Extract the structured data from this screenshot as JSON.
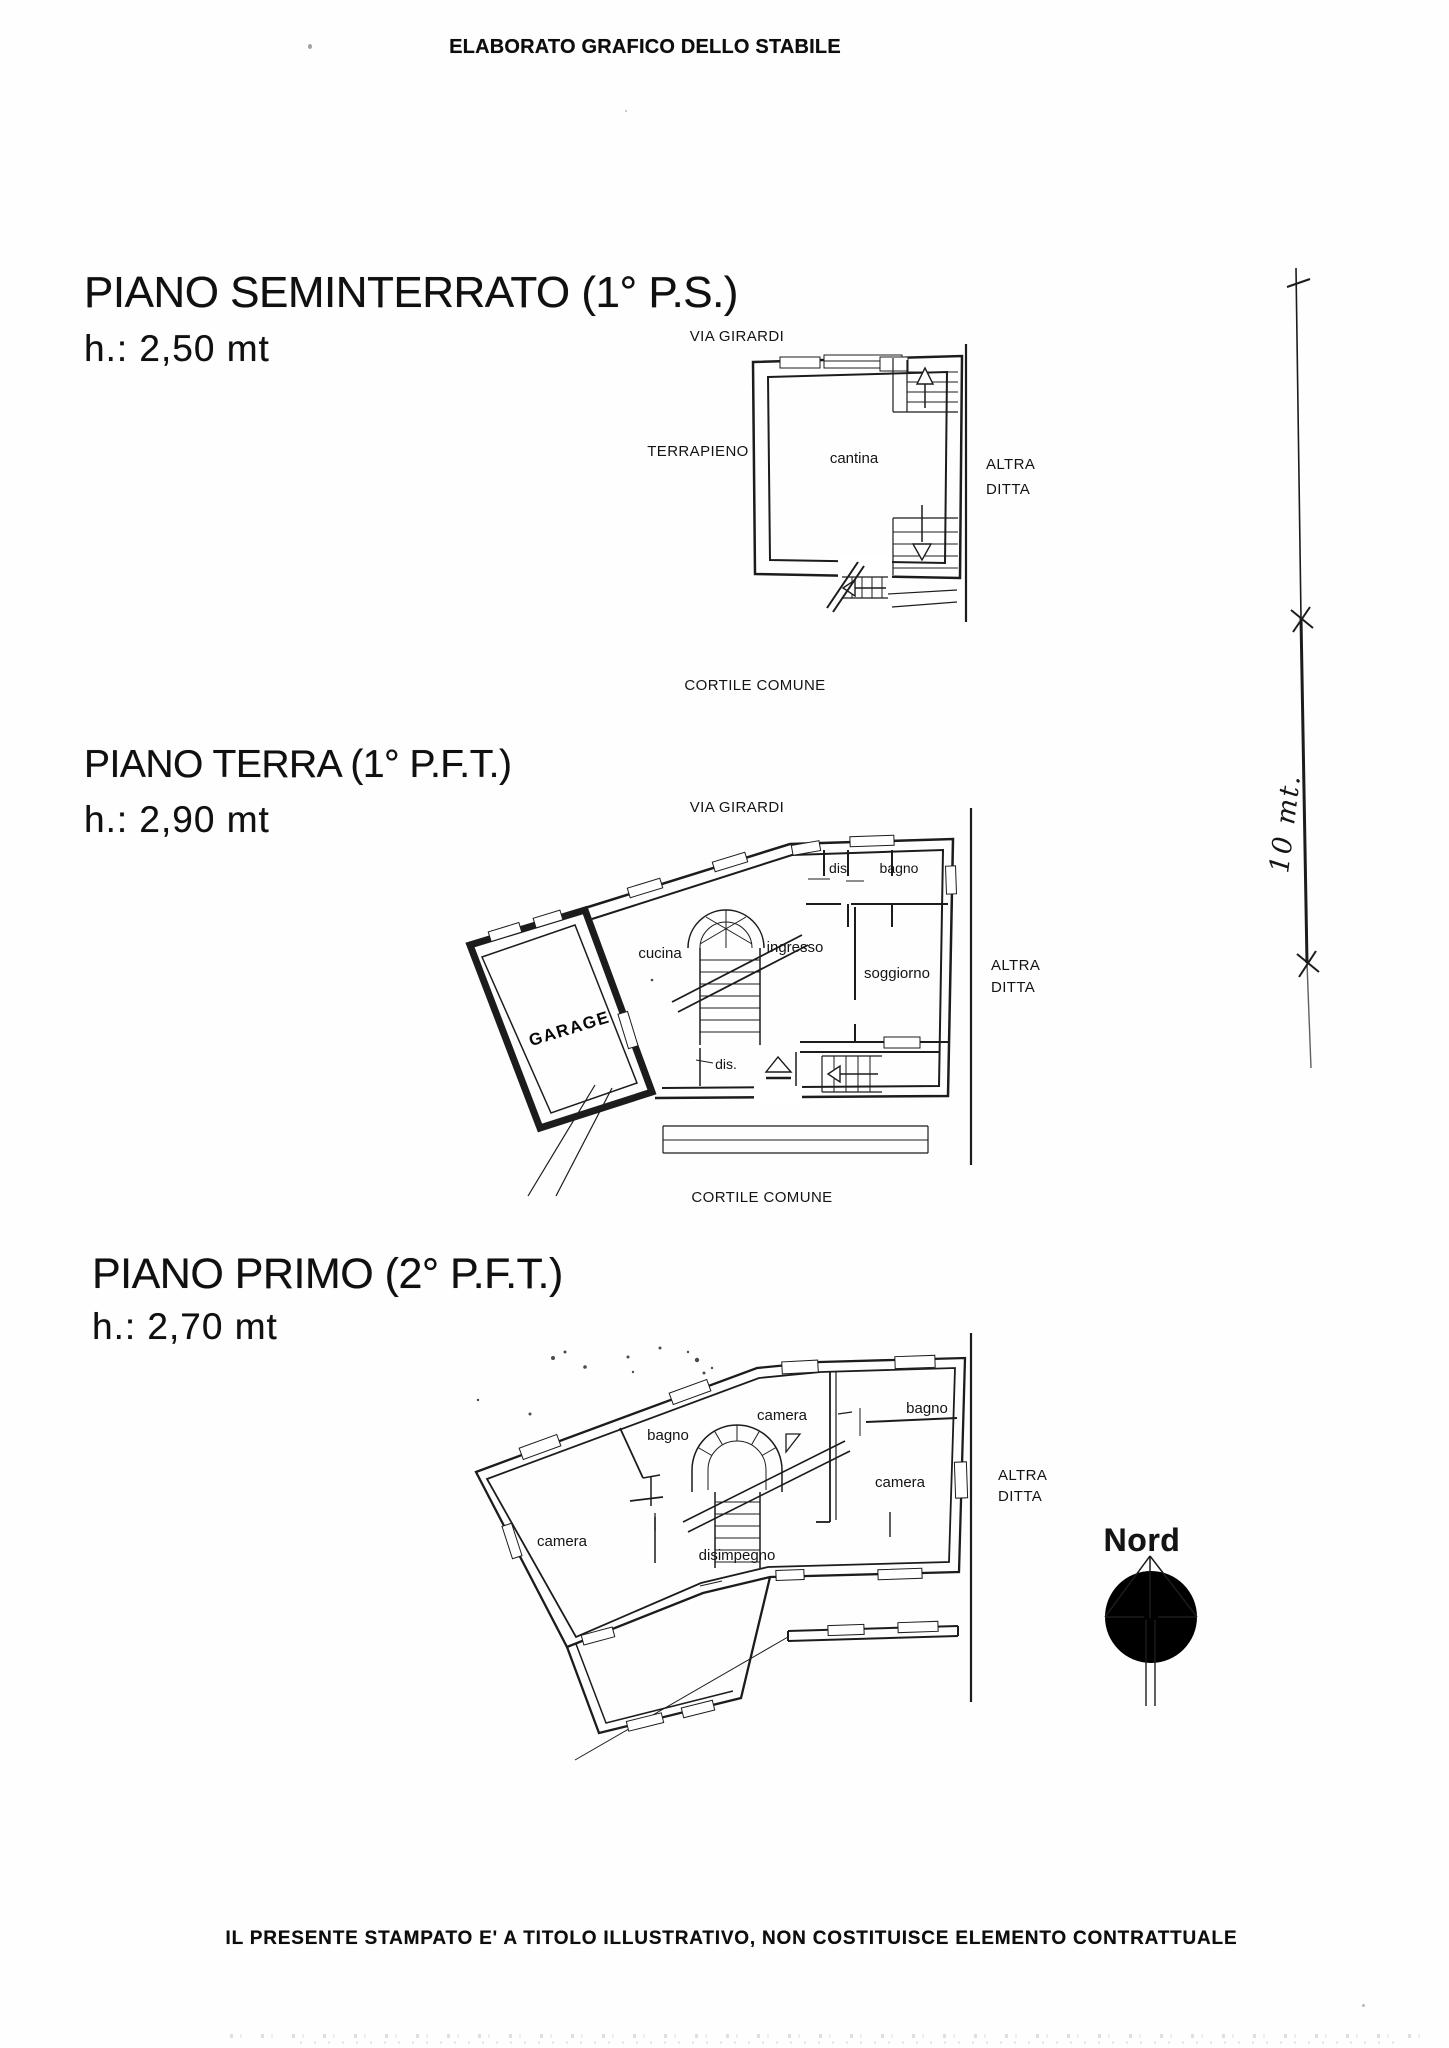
{
  "document": {
    "title": "ELABORATO GRAFICO DELLO STABILE",
    "disclaimer": "IL PRESENTE STAMPATO E' A TITOLO ILLUSTRATIVO, NON COSTITUISCE ELEMENTO CONTRATTUALE"
  },
  "sections": [
    {
      "title": "PIANO SEMINTERRATO (1° P.S.)",
      "height_label": "h.: 2,50 mt",
      "labels": {
        "street": "VIA GIRARDI",
        "embankment": "TERRAPIENO",
        "cellar": "cantina",
        "neighbor_line1": "ALTRA",
        "neighbor_line2": "DITTA",
        "courtyard": "CORTILE COMUNE"
      }
    },
    {
      "title": "PIANO TERRA (1° P.F.T.)",
      "height_label": "h.: 2,90 mt",
      "labels": {
        "street": "VIA GIRARDI",
        "garage": "GARAGE",
        "kitchen": "cucina",
        "entry": "ingresso",
        "living_room": "soggiorno",
        "closet_top": "dis",
        "bath_top": "bagno",
        "closet_bottom": "dis.",
        "neighbor_line1": "ALTRA",
        "neighbor_line2": "DITTA",
        "courtyard": "CORTILE COMUNE"
      }
    },
    {
      "title": "PIANO PRIMO (2° P.F.T.)",
      "height_label": "h.: 2,70 mt",
      "labels": {
        "bath_left": "bagno",
        "bedroom_top": "camera",
        "bath_right": "bagno",
        "bedroom_right": "camera",
        "bedroom_left": "camera",
        "hallway": "disimpegno",
        "neighbor_line1": "ALTRA",
        "neighbor_line2": "DITTA"
      }
    }
  ],
  "compass": {
    "north_label": "Nord"
  },
  "dimension_line": {
    "measurement": "10 mt."
  }
}
